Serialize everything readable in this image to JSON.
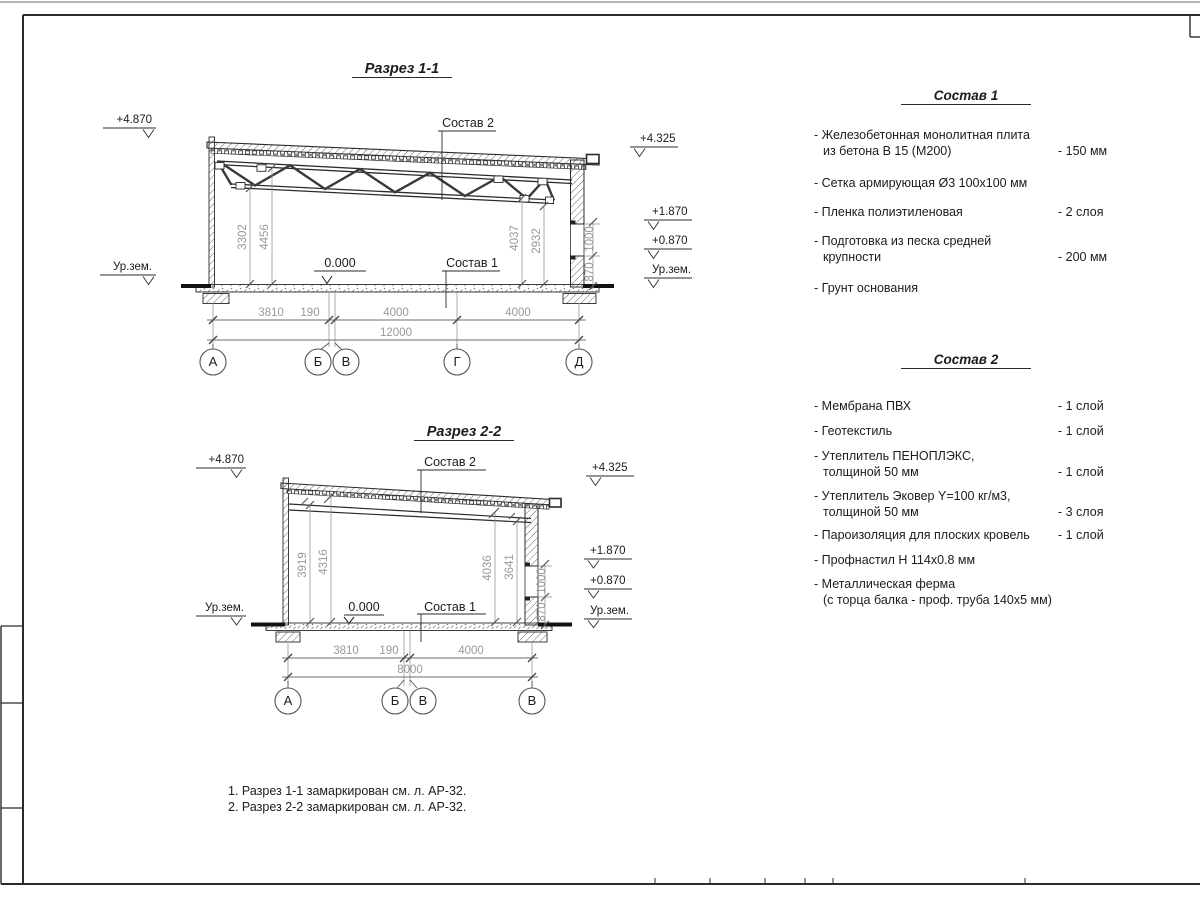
{
  "section1": {
    "title": "Разрез 1-1",
    "elevations": {
      "left_top": "+4.870",
      "left_ground": "Ур.зем.",
      "right_top": "+4.325",
      "right_mid": "+1.870",
      "right_low": "+0.870",
      "right_ground": "Ур.зем."
    },
    "labels": {
      "roof": "Состав 2",
      "floor": "Состав 1",
      "zero": "0.000"
    },
    "vdims": [
      "3302",
      "4456",
      "4037",
      "2932"
    ],
    "walldims": [
      "870",
      "1000"
    ],
    "hdims": [
      "3810",
      "190",
      "4000",
      "4000"
    ],
    "total": "12000",
    "axes": [
      "А",
      "Б",
      "В",
      "Г",
      "Д"
    ]
  },
  "section2": {
    "title": "Разрез 2-2",
    "elevations": {
      "left_top": "+4.870",
      "left_ground": "Ур.зем.",
      "right_top": "+4.325",
      "right_mid": "+1.870",
      "right_low": "+0.870",
      "right_ground": "Ур.зем."
    },
    "labels": {
      "roof": "Состав 2",
      "floor": "Состав 1",
      "zero": "0.000"
    },
    "vdims": [
      "3919",
      "4316",
      "4036",
      "3641"
    ],
    "walldims": [
      "870",
      "1000"
    ],
    "hdims": [
      "3810",
      "190",
      "4000"
    ],
    "total": "8000",
    "axes": [
      "А",
      "Б",
      "В",
      "В"
    ]
  },
  "comp1": {
    "title": "Состав 1",
    "items": [
      {
        "name": "- Железобетонная  монолитная плита\nиз бетона В 15 (М200)",
        "qty": "- 150 мм"
      },
      {
        "name": "- Сетка армирующая Ø3 100х100 мм",
        "qty": ""
      },
      {
        "name": "- Пленка полиэтиленовая",
        "qty": "-  2 слоя"
      },
      {
        "name": "- Подготовка из песка средней\nкрупности",
        "qty": "- 200 мм"
      },
      {
        "name": "- Грунт основания",
        "qty": ""
      }
    ]
  },
  "comp2": {
    "title": "Состав 2",
    "items": [
      {
        "name": "- Мембрана ПВХ",
        "qty": "- 1 слой"
      },
      {
        "name": "- Геотекстиль",
        "qty": "- 1 слой"
      },
      {
        "name": "- Утеплитель ПЕНОПЛЭКС,\nтолщиной 50 мм",
        "qty": "- 1 слой"
      },
      {
        "name": "- Утеплитель Эковер Y=100 кг/м3,\nтолщиной 50 мм",
        "qty": "- 3 слоя"
      },
      {
        "name": "- Пароизоляция для плоских кровель",
        "qty": "- 1 слой"
      },
      {
        "name": "- Профнастил Н 114х0.8 мм",
        "qty": ""
      },
      {
        "name": "- Металлическая ферма\n(с торца балка - проф. труба 140х5 мм)",
        "qty": ""
      }
    ]
  },
  "notes": [
    "1. Разрез 1-1 замаркирован см. л. АР-32.",
    "2. Разрез 2-2 замаркирован см. л. АР-32."
  ]
}
